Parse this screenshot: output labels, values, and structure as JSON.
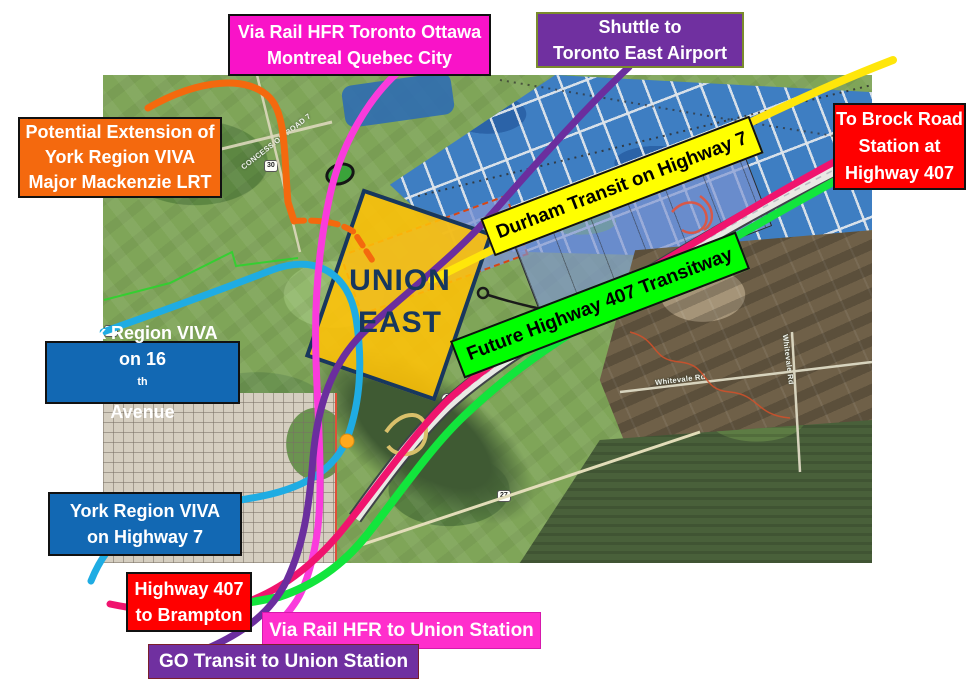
{
  "labels": {
    "via_rail_top": {
      "line1": "Via Rail HFR Toronto Ottawa",
      "line2": "Montreal Quebec City",
      "bg": "#F913C8"
    },
    "shuttle": {
      "line1": "Shuttle to",
      "line2": "Toronto East Airport",
      "bg": "#7030A0"
    },
    "viva_extension": {
      "line1": "Potential  Extension of",
      "line2": "York Region VIVA",
      "line3": "Major Mackenzie LRT",
      "bg": "#F4690E"
    },
    "brock_road": {
      "line1": "To Brock Road",
      "line2": "Station at",
      "line3": "Highway 407",
      "bg": "#FF0000"
    },
    "durham_transit": {
      "text": "Durham Transit on Highway 7",
      "bg": "#FFFF00"
    },
    "transitway": {
      "text": "Future Highway 407 Transitway",
      "bg": "#00FF00"
    },
    "viva_16th": {
      "line1": "York Region VIVA",
      "line2_pre": "on 16",
      "line2_sup": "th",
      "line2_post": " Avenue",
      "bg": "#1268B3"
    },
    "viva_hwy7": {
      "line1": "York Region VIVA",
      "line2": "on Highway 7",
      "bg": "#1268B3"
    },
    "brampton": {
      "line1": "Highway 407",
      "line2": "to Brampton",
      "bg": "#FF0000"
    },
    "via_rail_bottom": {
      "text": "Via Rail HFR to Union Station",
      "bg": "#FF2ECC"
    },
    "go_transit": {
      "text": "GO Transit to Union Station",
      "bg": "#7030A0"
    }
  },
  "station": {
    "line1": "UNION",
    "line2": "EAST",
    "fill": "#FFC000",
    "border": "#17375E"
  },
  "map": {
    "road_concession": "CONCESSION ROAD 7",
    "road_whitevale": "Whitevale Rd",
    "shield_48": "48",
    "shield_30": "30",
    "shield_27": "27",
    "shield_407": "407"
  },
  "routes": {
    "via_rail_hfr": {
      "color": "#FA3BDC"
    },
    "go_transit_shuttle": {
      "color": "#6B2E9E"
    },
    "viva_lrt_extension": {
      "color": "#F4690E"
    },
    "durham_transit_hwy7": {
      "color": "#FFE60A"
    },
    "highway_407": {
      "color": "#F0146E"
    },
    "transitway_407": {
      "color": "#12E53C"
    },
    "york_viva": {
      "color": "#1FACE3"
    },
    "station_dot": {
      "color": "#FFA91E"
    }
  }
}
